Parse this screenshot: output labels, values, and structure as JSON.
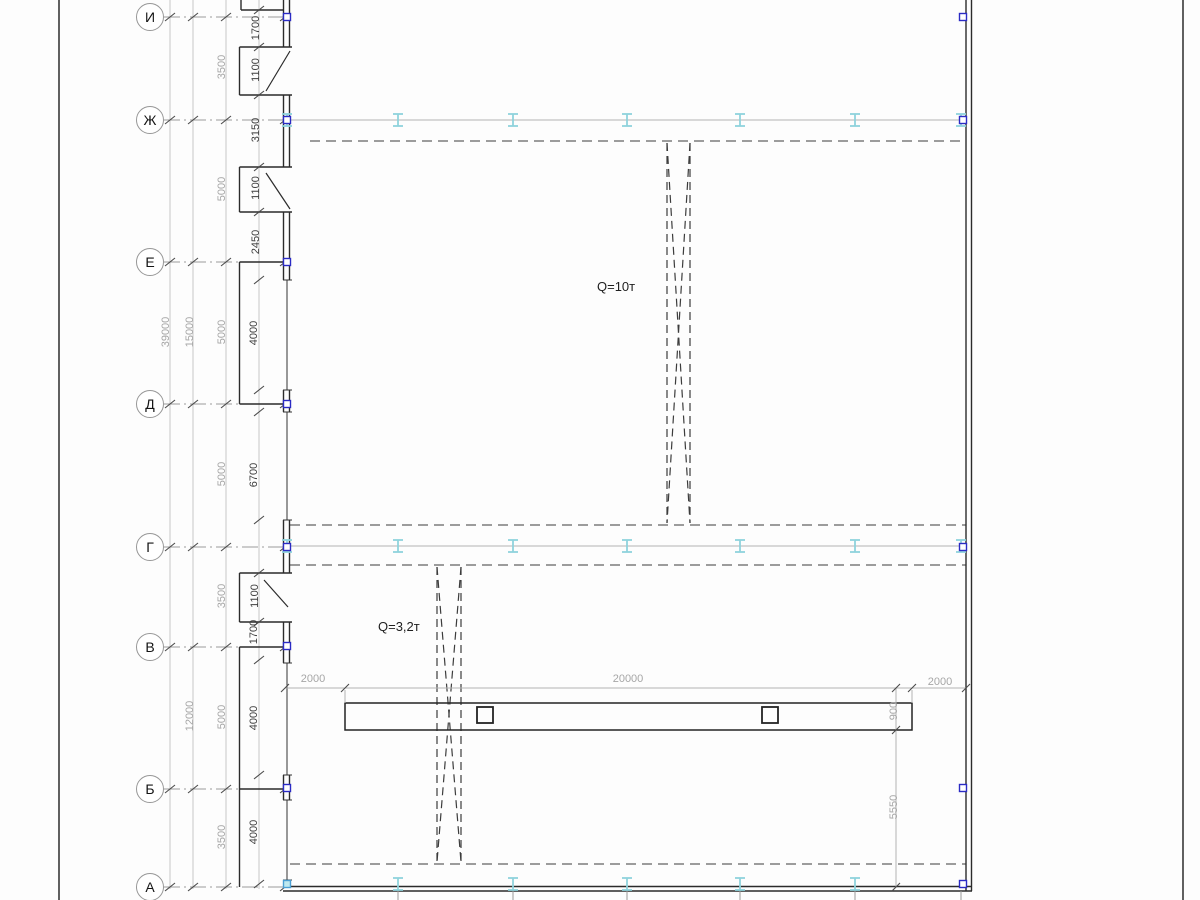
{
  "axes": [
    "И",
    "Ж",
    "Е",
    "Д",
    "Г",
    "В",
    "Б",
    "А"
  ],
  "cranes": [
    {
      "label": "Q=10т"
    },
    {
      "label": "Q=3,2т"
    }
  ],
  "dims": {
    "total": "39000",
    "sub": [
      "15000",
      "12000"
    ],
    "spacing": [
      "3500",
      "5000",
      "5000",
      "5000",
      "3500",
      "5000",
      "3500"
    ],
    "detail": [
      "1700",
      "1100",
      "3150",
      "1100",
      "2450",
      "4000",
      "6700",
      "1100",
      "1700",
      "4000",
      "4000"
    ],
    "bottom": [
      "2000",
      "20000",
      "2000"
    ],
    "right": [
      "900",
      "5550"
    ]
  },
  "icons": {
    "rail_symbol": "crane-rail-ibeam",
    "grip_symbol": "selection-grip"
  },
  "colors": {
    "wall": "#2b2b2b",
    "dim_light": "#a6a6a6",
    "dim_dark": "#3e3e3e",
    "rail_cyan": "#8fd3dc",
    "grip_blue": "#2b2bc4"
  }
}
